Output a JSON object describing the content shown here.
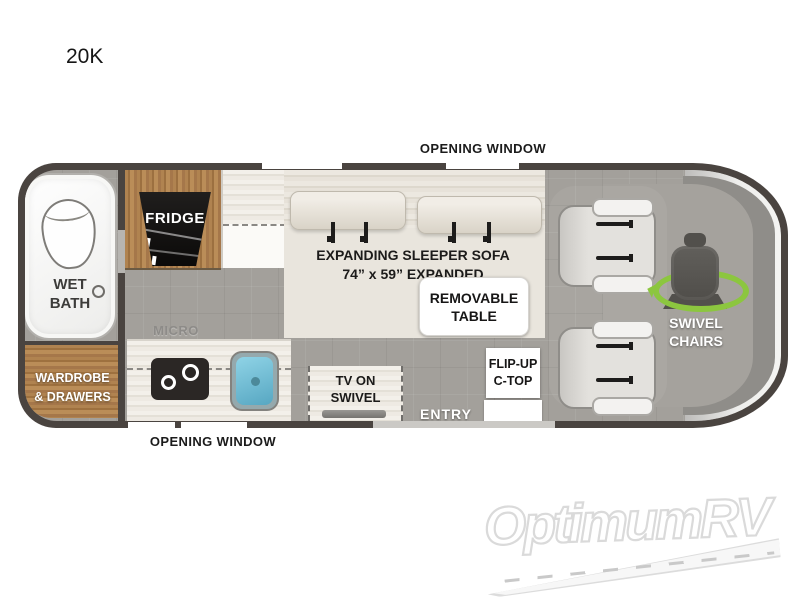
{
  "page": {
    "model": "20K",
    "watermark": "OptimumRV"
  },
  "labels": {
    "opening_window_top": "OPENING WINDOW",
    "opening_window_bottom": "OPENING WINDOW",
    "wet_bath_line1": "WET",
    "wet_bath_line2": "BATH",
    "wardrobe_line1": "WARDROBE",
    "wardrobe_line2": "& DRAWERS",
    "fridge": "FRIDGE",
    "micro": "MICRO",
    "sofa_line1": "EXPANDING SLEEPER SOFA",
    "sofa_line2": "74” x 59” EXPANDED",
    "table_line1": "REMOVABLE",
    "table_line2": "TABLE",
    "tv_line1": "TV ON",
    "tv_line2": "SWIVEL",
    "ctop_line1": "FLIP-UP",
    "ctop_line2": "C-TOP",
    "entry": "ENTRY",
    "swivel_line1": "SWIVEL",
    "swivel_line2": "CHAIRS"
  },
  "icons": {
    "toilet": "ellipse-outline",
    "drain": "circle-outline",
    "fridge": "black-trapezoid",
    "cooktop": "two-burner-stove",
    "sink": "blue-basin",
    "seatbelt": "belt-bar",
    "tv": "gray-bar",
    "swivel_chair": "seat-silhouette",
    "swivel_arrow": "green-ellipse-arrow"
  },
  "colors": {
    "wall": "#4a4440",
    "floor": "#a3a09b",
    "wood": "#ab7f4d",
    "sofa": "#e9e5dd",
    "counter": "#efece5",
    "sink_blue": "#62b4cf",
    "swivel_green": "#8cc63f",
    "fridge_black": "#141312",
    "watermark_gray": "#dedede"
  }
}
